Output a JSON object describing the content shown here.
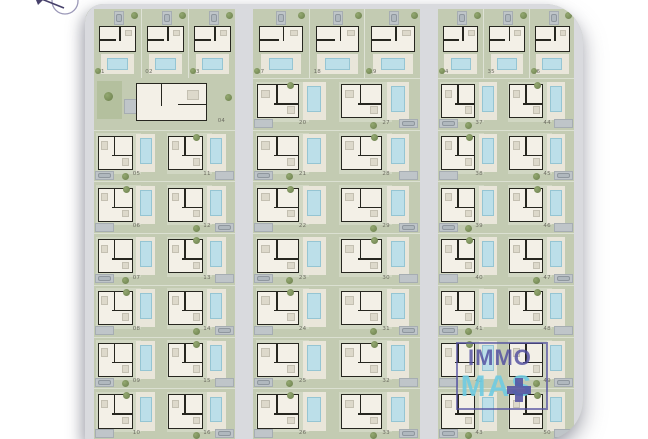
{
  "title": "residential development site plan",
  "plots": {
    "blocks": [
      {
        "name": "block-left",
        "top_row": [
          "01",
          "02",
          "03"
        ],
        "wide_villa": "04",
        "left_column": [
          "05",
          "06",
          "07",
          "08",
          "09",
          "10"
        ],
        "right_column": [
          "11",
          "12",
          "13",
          "14",
          "15",
          "16"
        ]
      },
      {
        "name": "block-middle",
        "top_row": [
          "17",
          "18",
          "19"
        ],
        "left_column": [
          "20",
          "21",
          "22",
          "23",
          "24",
          "25",
          "26"
        ],
        "right_column": [
          "27",
          "28",
          "29",
          "30",
          "31",
          "32",
          "33"
        ]
      },
      {
        "name": "block-right",
        "top_row": [
          "34",
          "35",
          "36"
        ],
        "left_column": [
          "37",
          "38",
          "39",
          "40",
          "41",
          "42",
          "43"
        ],
        "right_column": [
          "44",
          "45",
          "46",
          "47",
          "48",
          "49",
          "50"
        ]
      }
    ]
  },
  "watermark": {
    "word1": "IMMO",
    "word2": "MAS"
  },
  "icons": [
    "compass-icon",
    "car-icon",
    "tree-icon",
    "plus-icon",
    "pool-icon"
  ],
  "colors": {
    "ground": "#c3cbb2",
    "ground_light": "#d1d7c3",
    "road": "#d9dade",
    "wall": "#26261f",
    "building": "#f3f0e7",
    "deck": "#e9e6da",
    "pool": "#bcdfe9",
    "pool_border": "#95c5d3",
    "parking": "#bfc5c9",
    "parking_border": "#a6adb2",
    "car": "#b0b8be",
    "car_border": "#8f979e",
    "tree": "#7d915c",
    "tree_dark": "#6b7f4e",
    "number": "#6d6d62",
    "logo_purple": "#514ea0",
    "logo_blue": "#6fcbe2",
    "compass": "#47416b",
    "compass_ring": "#9b98b8"
  }
}
